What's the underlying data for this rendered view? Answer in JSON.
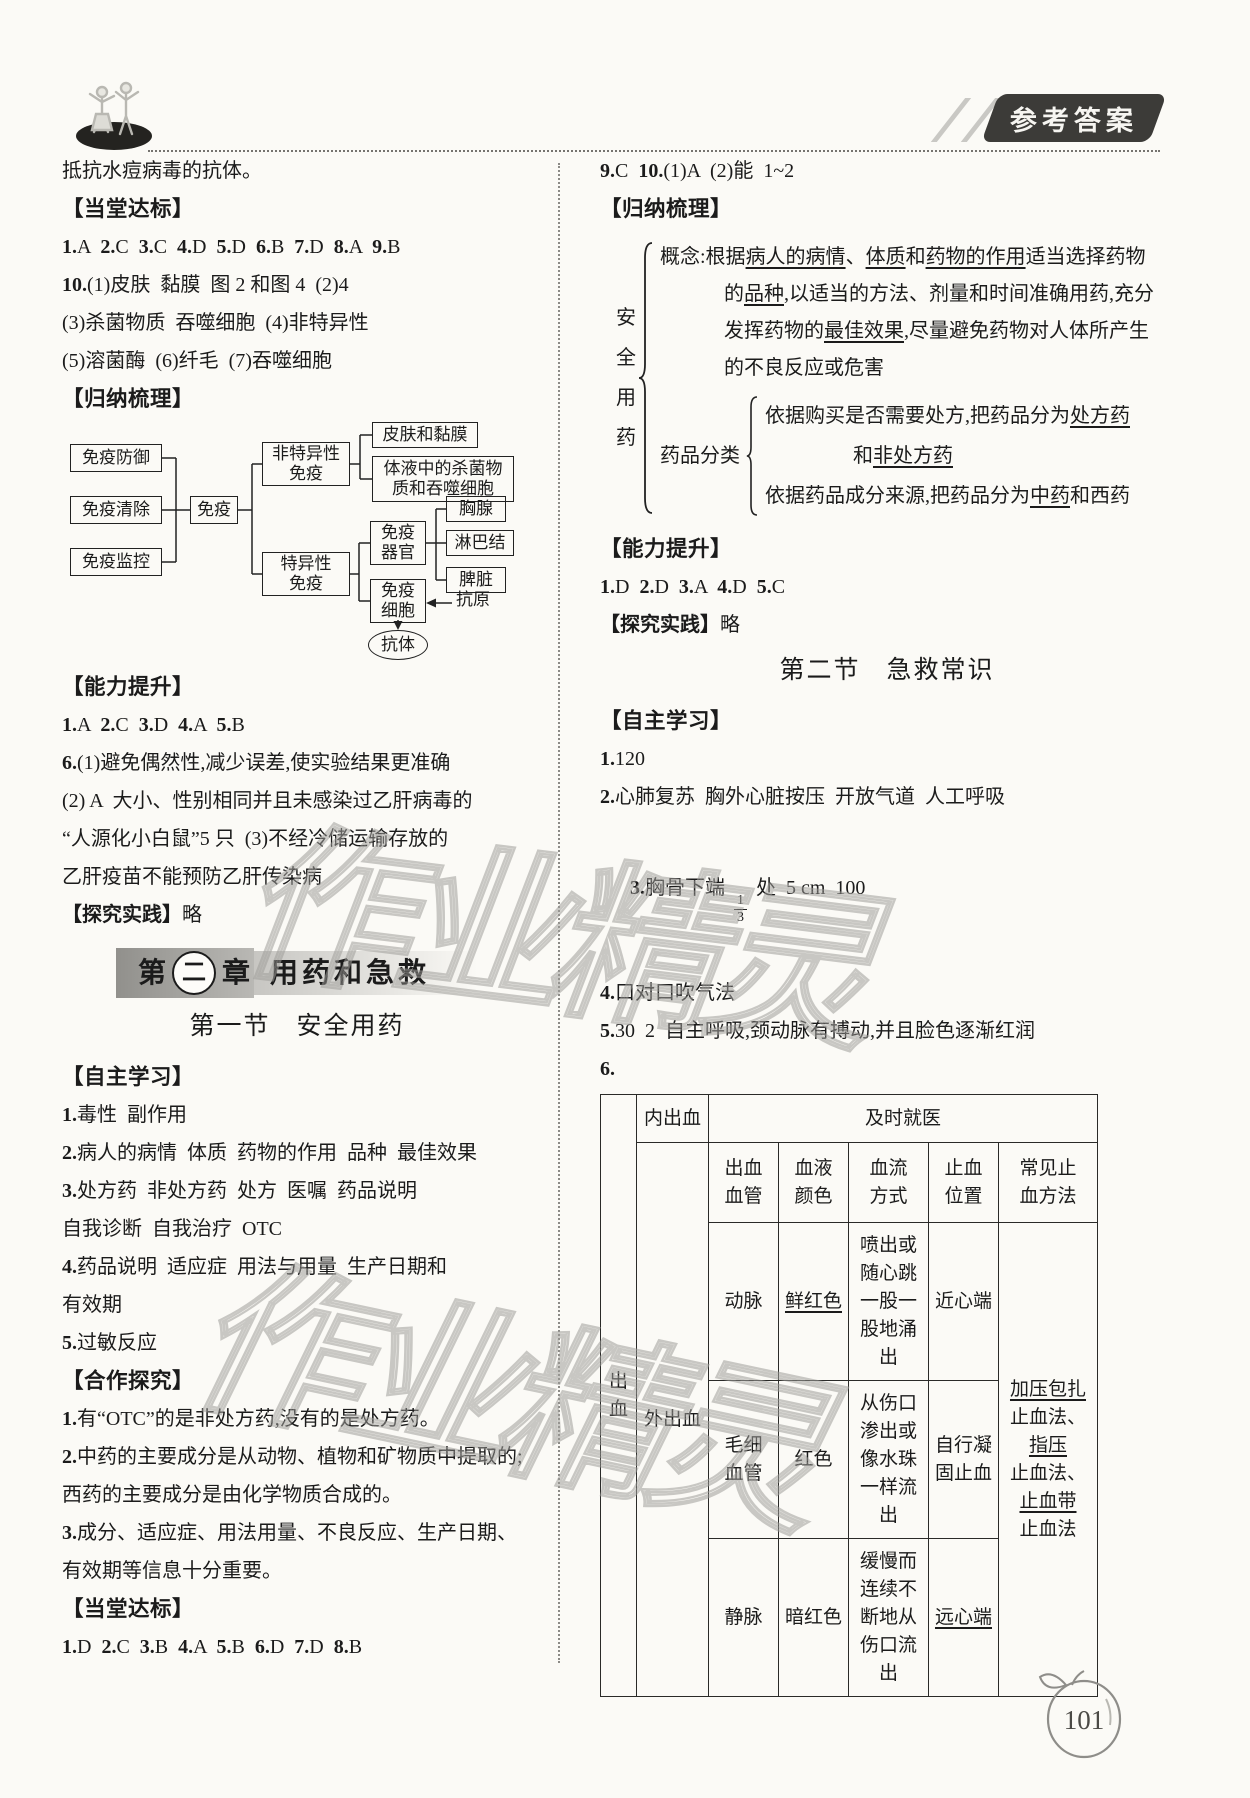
{
  "header": {
    "badge": "参考答案"
  },
  "watermark": {
    "text": "作业精灵"
  },
  "page": {
    "number": "101"
  },
  "left": {
    "cont": "抵抗水痘病毒的抗体。",
    "h_dangtang": "【当堂达标】",
    "ans1": [
      {
        "t": "1.",
        "b": 1
      },
      {
        "t": "A  "
      },
      {
        "t": "2.",
        "b": 1
      },
      {
        "t": "C  "
      },
      {
        "t": "3.",
        "b": 1
      },
      {
        "t": "C  "
      },
      {
        "t": "4.",
        "b": 1
      },
      {
        "t": "D  "
      },
      {
        "t": "5.",
        "b": 1
      },
      {
        "t": "D  "
      },
      {
        "t": "6.",
        "b": 1
      },
      {
        "t": "B  "
      },
      {
        "t": "7.",
        "b": 1
      },
      {
        "t": "D  "
      },
      {
        "t": "8.",
        "b": 1
      },
      {
        "t": "A  "
      },
      {
        "t": "9.",
        "b": 1
      },
      {
        "t": "B"
      }
    ],
    "q10a": [
      {
        "t": "10.",
        "b": 1
      },
      {
        "t": "(1)皮肤  黏膜  图 2 和图 4  (2)4"
      }
    ],
    "q10b": "(3)杀菌物质  吞噬细胞  (4)非特异性",
    "q10c": "(5)溶菌酶  (6)纤毛  (7)吞噬细胞",
    "h_guina": "【归纳梳理】",
    "diagram": {
      "defense": "免疫防御",
      "clear": "免疫清除",
      "monitor": "免疫监控",
      "root": "免疫",
      "nonspec": "非特异性\n免疫",
      "skin": "皮肤和黏膜",
      "fluid": "体液中的杀菌物\n质和吞噬细胞",
      "spec": "特异性\n免疫",
      "organ": "免疫\n器官",
      "thymus": "胸腺",
      "lymph": "淋巴结",
      "spleen": "脾脏",
      "cell": "免疫\n细胞",
      "antigen": "抗原",
      "antibody": "抗体"
    },
    "h_nengli": "【能力提升】",
    "ans2": [
      {
        "t": "1.",
        "b": 1
      },
      {
        "t": "A  "
      },
      {
        "t": "2.",
        "b": 1
      },
      {
        "t": "C  "
      },
      {
        "t": "3.",
        "b": 1
      },
      {
        "t": "D  "
      },
      {
        "t": "4.",
        "b": 1
      },
      {
        "t": "A  "
      },
      {
        "t": "5.",
        "b": 1
      },
      {
        "t": "B"
      }
    ],
    "q6a": [
      {
        "t": "6.",
        "b": 1
      },
      {
        "t": "(1)避免偶然性,减少误差,使实验结果更准确"
      }
    ],
    "q6b": "(2) A  大小、性别相同并且未感染过乙肝病毒的",
    "q6c": "“人源化小白鼠”5 只  (3)不经冷储运输存放的",
    "q6d": "乙肝疫苗不能预防乙肝传染病",
    "tanjiu": [
      {
        "t": "【探究实践】",
        "b": 1
      },
      {
        "t": "略"
      }
    ],
    "chapter": {
      "pre": "第",
      "num": "二",
      "post": "章",
      "title": "用药和急救"
    },
    "section": {
      "no": "第一节",
      "title": "安全用药"
    },
    "h_zizhu": "【自主学习】",
    "z1": [
      {
        "t": "1.",
        "b": 1
      },
      {
        "t": "毒性  副作用"
      }
    ],
    "z2": [
      {
        "t": "2.",
        "b": 1
      },
      {
        "t": "病人的病情  体质  药物的作用  品种  最佳效果"
      }
    ],
    "z3": [
      {
        "t": "3.",
        "b": 1
      },
      {
        "t": "处方药  非处方药  处方  医嘱  药品说明"
      }
    ],
    "z3b": "自我诊断  自我治疗  OTC",
    "z4": [
      {
        "t": "4.",
        "b": 1
      },
      {
        "t": "药品说明  适应症  用法与用量  生产日期和"
      }
    ],
    "z4b": "有效期",
    "z5": [
      {
        "t": "5.",
        "b": 1
      },
      {
        "t": "过敏反应"
      }
    ],
    "h_hezuo": "【合作探究】",
    "hz1": [
      {
        "t": "1.",
        "b": 1
      },
      {
        "t": "有“OTC”的是非处方药,没有的是处方药。"
      }
    ],
    "hz2": [
      {
        "t": "2.",
        "b": 1
      },
      {
        "t": "中药的主要成分是从动物、植物和矿物质中提取的;西药的主要成分是由化学物质合成的。"
      }
    ],
    "hz3": [
      {
        "t": "3.",
        "b": 1
      },
      {
        "t": "成分、适应症、用法用量、不良反应、生产日期、有效期等信息十分重要。"
      }
    ],
    "h_dangtang2": "【当堂达标】",
    "ans3": [
      {
        "t": "1.",
        "b": 1
      },
      {
        "t": "D  "
      },
      {
        "t": "2.",
        "b": 1
      },
      {
        "t": "C  "
      },
      {
        "t": "3.",
        "b": 1
      },
      {
        "t": "B  "
      },
      {
        "t": "4.",
        "b": 1
      },
      {
        "t": "A  "
      },
      {
        "t": "5.",
        "b": 1
      },
      {
        "t": "B  "
      },
      {
        "t": "6.",
        "b": 1
      },
      {
        "t": "D  "
      },
      {
        "t": "7.",
        "b": 1
      },
      {
        "t": "D  "
      },
      {
        "t": "8.",
        "b": 1
      },
      {
        "t": "B"
      }
    ]
  },
  "right": {
    "r1": [
      {
        "t": "9.",
        "b": 1
      },
      {
        "t": "C  "
      },
      {
        "t": "10.",
        "b": 1
      },
      {
        "t": "(1)A  (2)能  1~2"
      }
    ],
    "h_guina": "【归纳梳理】",
    "brace": {
      "vlabel": "安全用药",
      "concept": [
        {
          "t": "概念:根据"
        },
        {
          "t": "病人的病情",
          "u": 1
        },
        {
          "t": "、"
        },
        {
          "t": "体质",
          "u": 1
        },
        {
          "t": "和"
        },
        {
          "t": "药物的作用",
          "u": 1
        },
        {
          "t": "适当选择药物的"
        },
        {
          "t": "品种",
          "u": 1
        },
        {
          "t": ",以适当的方法、剂量和时间准确用药,充分发挥药物的"
        },
        {
          "t": "最佳效果",
          "u": 1
        },
        {
          "t": ",尽量避免药物对人体所产生的不良反应或危害"
        }
      ],
      "fenlei_label": "药品分类",
      "fenlei1": [
        {
          "t": "依据购买是否需要处方,把药品分为"
        },
        {
          "t": "处方药",
          "u": 1
        }
      ],
      "fenlei1b": [
        {
          "t": "和"
        },
        {
          "t": "非处方药",
          "u": 1
        }
      ],
      "fenlei2": [
        {
          "t": "依据药品成分来源,把药品分为"
        },
        {
          "t": "中药",
          "u": 1
        },
        {
          "t": "和西药"
        }
      ]
    },
    "h_nengli": "【能力提升】",
    "ans4": [
      {
        "t": "1.",
        "b": 1
      },
      {
        "t": "D  "
      },
      {
        "t": "2.",
        "b": 1
      },
      {
        "t": "D  "
      },
      {
        "t": "3.",
        "b": 1
      },
      {
        "t": "A  "
      },
      {
        "t": "4.",
        "b": 1
      },
      {
        "t": "D  "
      },
      {
        "t": "5.",
        "b": 1
      },
      {
        "t": "C"
      }
    ],
    "tanjiu": [
      {
        "t": "【探究实践】",
        "b": 1
      },
      {
        "t": "略"
      }
    ],
    "section": {
      "no": "第二节",
      "title": "急救常识"
    },
    "h_zizhu": "【自主学习】",
    "j1": [
      {
        "t": "1.",
        "b": 1
      },
      {
        "t": "120"
      }
    ],
    "j2": [
      {
        "t": "2.",
        "b": 1
      },
      {
        "t": "心肺复苏  胸外心脏按压  开放气道  人工呼吸"
      }
    ],
    "j3": {
      "pre": [
        {
          "t": "3.",
          "b": 1
        },
        {
          "t": "胸骨下端 "
        }
      ],
      "num": "1",
      "den": "3",
      "post": " 处  5 cm  100"
    },
    "j4": [
      {
        "t": "4.",
        "b": 1
      },
      {
        "t": "口对口吹气法"
      }
    ],
    "j5": [
      {
        "t": "5.",
        "b": 1
      },
      {
        "t": "30  2  自主呼吸,颈动脉有搏动,并且脸色逐渐红润"
      }
    ],
    "j6": [
      {
        "t": "6.",
        "b": 1
      }
    ],
    "table": {
      "bleed": "出血",
      "internal": "内出血",
      "seek": "及时就医",
      "external": "外出血",
      "headers": [
        "出血\n血管",
        "血液\n颜色",
        "血流\n方式",
        "止血\n位置",
        "常见止\n血方法"
      ],
      "rows": [
        {
          "vessel": "动脉",
          "color": [
            {
              "t": "鲜红色",
              "u": 1
            }
          ],
          "flow": "喷出或随心跳一股一股地涌出",
          "pos": [
            {
              "t": "近心端"
            }
          ]
        },
        {
          "vessel": "毛细\n血管",
          "color": [
            {
              "t": "红色"
            }
          ],
          "flow": "从伤口渗出或像水珠一样流出",
          "pos": [
            {
              "t": "自行凝固止血"
            }
          ]
        },
        {
          "vessel": "静脉",
          "color": [
            {
              "t": "暗红色"
            }
          ],
          "flow": "缓慢而连续不断地从伤口流出",
          "pos": [
            {
              "t": "远心端",
              "u": 1
            }
          ]
        }
      ],
      "methods": [
        {
          "t": "加压包扎",
          "u": 1
        },
        {
          "t": "\n止血法、\n"
        },
        {
          "t": "指压",
          "u": 1
        },
        {
          "t": "\n止血法、\n"
        },
        {
          "t": "止血带",
          "u": 1
        },
        {
          "t": "\n止血法"
        }
      ]
    }
  }
}
